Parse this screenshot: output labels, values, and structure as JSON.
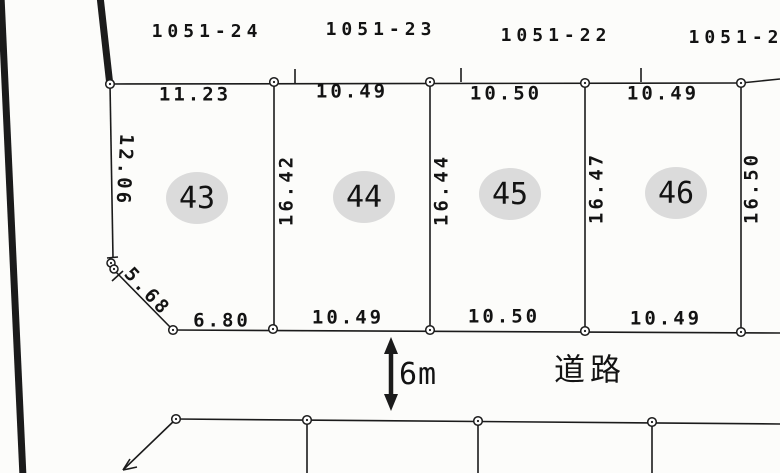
{
  "parcels": [
    "1051-24",
    "1051-23",
    "1051-22",
    "1051-2"
  ],
  "lots": [
    "43",
    "44",
    "45",
    "46"
  ],
  "top_dims": [
    "11.23",
    "10.49",
    "10.50",
    "10.49"
  ],
  "bottom_dims": [
    "6.80",
    "10.49",
    "10.50",
    "10.49"
  ],
  "divider_dims": [
    "16.42",
    "16.44",
    "16.47",
    "16.50"
  ],
  "left_dim": "12.06",
  "diagonal_dim": "5.68",
  "road": {
    "width_label": "6m",
    "name_label": "道路"
  },
  "colors": {
    "line": "#1b1b1b",
    "badge": "#dbdbdb",
    "background": "#fcfcfa",
    "text": "#131313"
  }
}
